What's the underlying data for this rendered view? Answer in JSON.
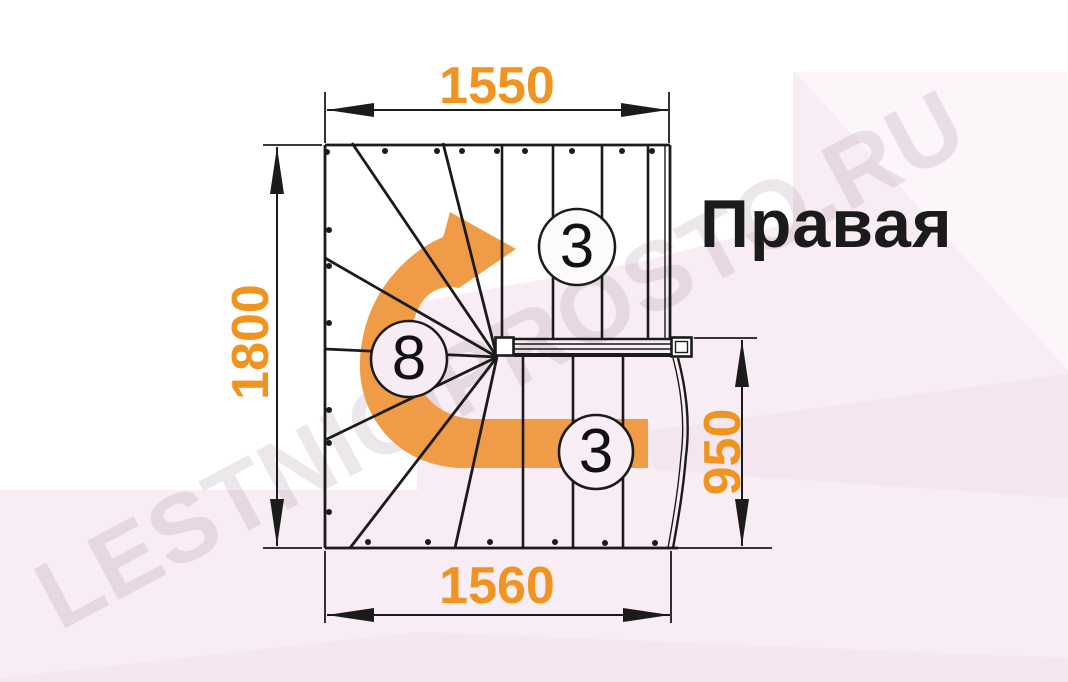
{
  "diagram": {
    "orientation_label": "Правая",
    "watermark": "LESTNICIPROSTO.RU",
    "dimensions": {
      "top_width": "1550",
      "left_height": "1800",
      "bottom_width": "1560",
      "right_height": "950"
    },
    "step_counts": {
      "upper_flight": "3",
      "winders": "8",
      "lower_flight": "3"
    },
    "icons": {
      "turn_arrow": "curved-right-turn-arrow"
    },
    "colors": {
      "dimension_text": "#F0931F",
      "turn_arrow": "#F09B45",
      "line": "#1B1B1B",
      "background_tint": "#F8EDF4"
    }
  }
}
